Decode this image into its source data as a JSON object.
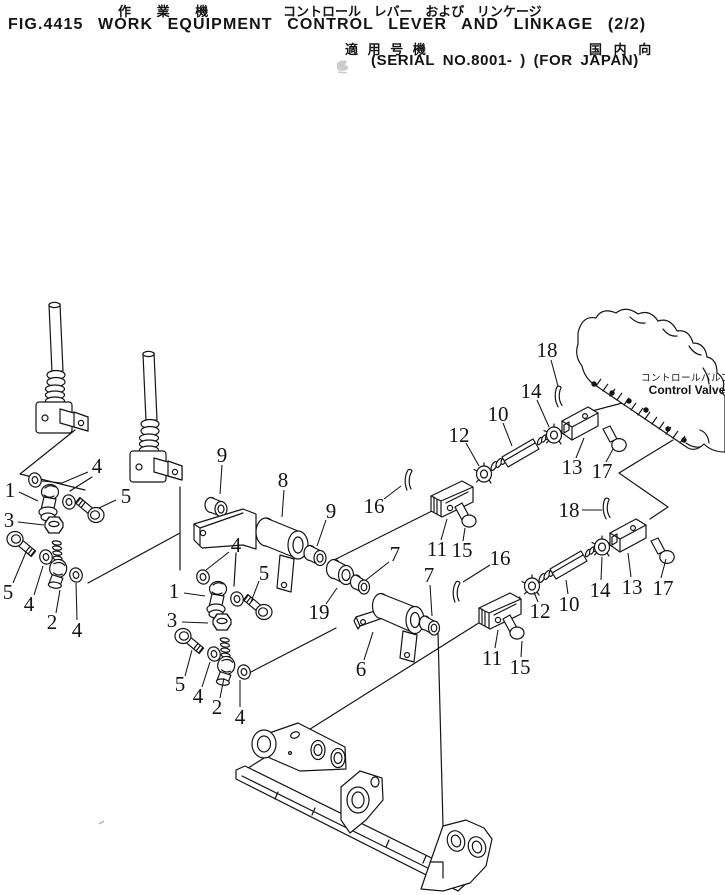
{
  "header": {
    "title_jp_left": "作 業 機",
    "title_jp_right": "コントロール レバー および リンケージ",
    "title_en": "FIG.4415 WORK EQUIPMENT CONTROL LEVER AND LINKAGE (2/2)",
    "applicable_jp": "適 用 号 機",
    "domestic_jp": "国 内 向",
    "serial_line": "(SERIAL NO.8001- ) (FOR JAPAN)"
  },
  "control_valve": {
    "label_jp": "コントロールバルブ",
    "label_en": "Control Valve"
  },
  "colors": {
    "ink": "#141414",
    "paper": "#ffffff"
  },
  "callouts": [
    {
      "n": "4",
      "x": 97,
      "y": 466,
      "leader": "88,472 62,483 42,481"
    },
    {
      "n": "1",
      "x": 10,
      "y": 490,
      "leader": "19,492 38,501"
    },
    {
      "n": "5",
      "x": 126,
      "y": 496,
      "leader": "116,500 99,508"
    },
    {
      "n": "3",
      "x": 9,
      "y": 520,
      "leader": "18,522 44,525"
    },
    {
      "n": "5",
      "x": 8,
      "y": 592,
      "leader": "13,583 26,552"
    },
    {
      "n": "4",
      "x": 29,
      "y": 604,
      "leader": "34,595 43,566"
    },
    {
      "n": "2",
      "x": 52,
      "y": 622,
      "leader": "56,613 60,590"
    },
    {
      "n": "4",
      "x": 77,
      "y": 630,
      "leader": "77,620 76,583"
    },
    {
      "n": "4",
      "x": 236,
      "y": 545,
      "leader": "229,552 206,570"
    },
    {
      "n": "1",
      "x": 174,
      "y": 591,
      "leader": "184,593 205,596"
    },
    {
      "n": "3",
      "x": 172,
      "y": 620,
      "leader": "182,622 208,623"
    },
    {
      "n": "5",
      "x": 264,
      "y": 573,
      "leader": "259,581 251,602"
    },
    {
      "n": "5",
      "x": 180,
      "y": 684,
      "leader": "185,676 192,650"
    },
    {
      "n": "4",
      "x": 198,
      "y": 696,
      "leader": "202,687 210,662"
    },
    {
      "n": "2",
      "x": 217,
      "y": 707,
      "leader": "220,698 224,678"
    },
    {
      "n": "4",
      "x": 240,
      "y": 717,
      "leader": "240,707 240,680"
    },
    {
      "n": "9",
      "x": 222,
      "y": 455,
      "leader": "222,465 220,494"
    },
    {
      "n": "8",
      "x": 283,
      "y": 480,
      "leader": "284,490 282,517"
    },
    {
      "n": "9",
      "x": 331,
      "y": 511,
      "leader": "326,520 317,546"
    },
    {
      "n": "19",
      "x": 319,
      "y": 612,
      "leader": "326,604 337,588"
    },
    {
      "n": "7",
      "x": 395,
      "y": 554,
      "leader": "389,562 366,580"
    },
    {
      "n": "7",
      "x": 429,
      "y": 575,
      "leader": "430,585 432,616"
    },
    {
      "n": "6",
      "x": 361,
      "y": 669,
      "leader": "364,660 373,632"
    },
    {
      "n": "16",
      "x": 374,
      "y": 506,
      "leader": "384,499 401,486"
    },
    {
      "n": "11",
      "x": 437,
      "y": 549,
      "leader": "441,540 447,519"
    },
    {
      "n": "15",
      "x": 462,
      "y": 550,
      "leader": "463,541 465,528"
    },
    {
      "n": "12",
      "x": 459,
      "y": 435,
      "leader": "466,443 479,466"
    },
    {
      "n": "10",
      "x": 498,
      "y": 414,
      "leader": "503,423 512,446"
    },
    {
      "n": "14",
      "x": 531,
      "y": 391,
      "leader": "537,400 549,427"
    },
    {
      "n": "18",
      "x": 547,
      "y": 350,
      "leader": "551,360 558,386"
    },
    {
      "n": "13",
      "x": 572,
      "y": 467,
      "leader": "576,458 584,438"
    },
    {
      "n": "17",
      "x": 602,
      "y": 471,
      "leader": "606,462 613,449"
    },
    {
      "n": "16",
      "x": 500,
      "y": 558,
      "leader": "490,565 463,582"
    },
    {
      "n": "18",
      "x": 569,
      "y": 510,
      "leader": "582,510 602,510"
    },
    {
      "n": "11",
      "x": 492,
      "y": 658,
      "leader": "495,648 498,630"
    },
    {
      "n": "15",
      "x": 520,
      "y": 667,
      "leader": "521,657 522,641"
    },
    {
      "n": "12",
      "x": 540,
      "y": 611,
      "leader": "538,602 534,592"
    },
    {
      "n": "10",
      "x": 569,
      "y": 604,
      "leader": "568,594 566,580"
    },
    {
      "n": "14",
      "x": 600,
      "y": 590,
      "leader": "601,580 602,557"
    },
    {
      "n": "13",
      "x": 632,
      "y": 587,
      "leader": "631,577 628,553"
    },
    {
      "n": "17",
      "x": 663,
      "y": 588,
      "leader": "661,578 666,559"
    }
  ]
}
